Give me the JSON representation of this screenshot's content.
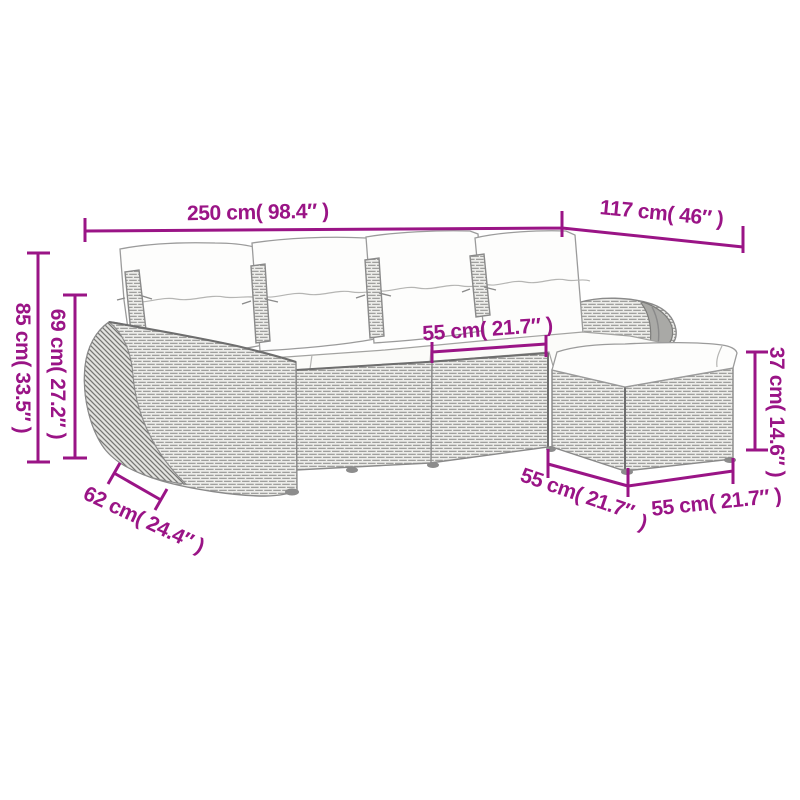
{
  "page": {
    "type": "product-dimension-diagram",
    "subject": "rattan corner sofa set with cushions and ottoman",
    "background": "#ffffff"
  },
  "style": {
    "accent_color": "#9A1486",
    "furniture_line_color": "#8a8a8a",
    "cushion_color": "#fdfdfc"
  },
  "measurements": {
    "total_width": "250 cm( 98.4″ )",
    "right_section_width": "117 cm( 46″ )",
    "back_height": "85 cm( 33.5″ )",
    "arm_height": "69 cm( 27.2″ )",
    "seat_width": "55 cm( 21.7″ )",
    "ottoman_height": "37 cm( 14.6″ )",
    "arm_depth": "62 cm( 24.4″ )",
    "ottoman_front_left_width_line1": "55 cm( 21.7″",
    "ottoman_front_left_width_line2": ")",
    "ottoman_front_right_width": "55 cm( 21.7″ )"
  }
}
